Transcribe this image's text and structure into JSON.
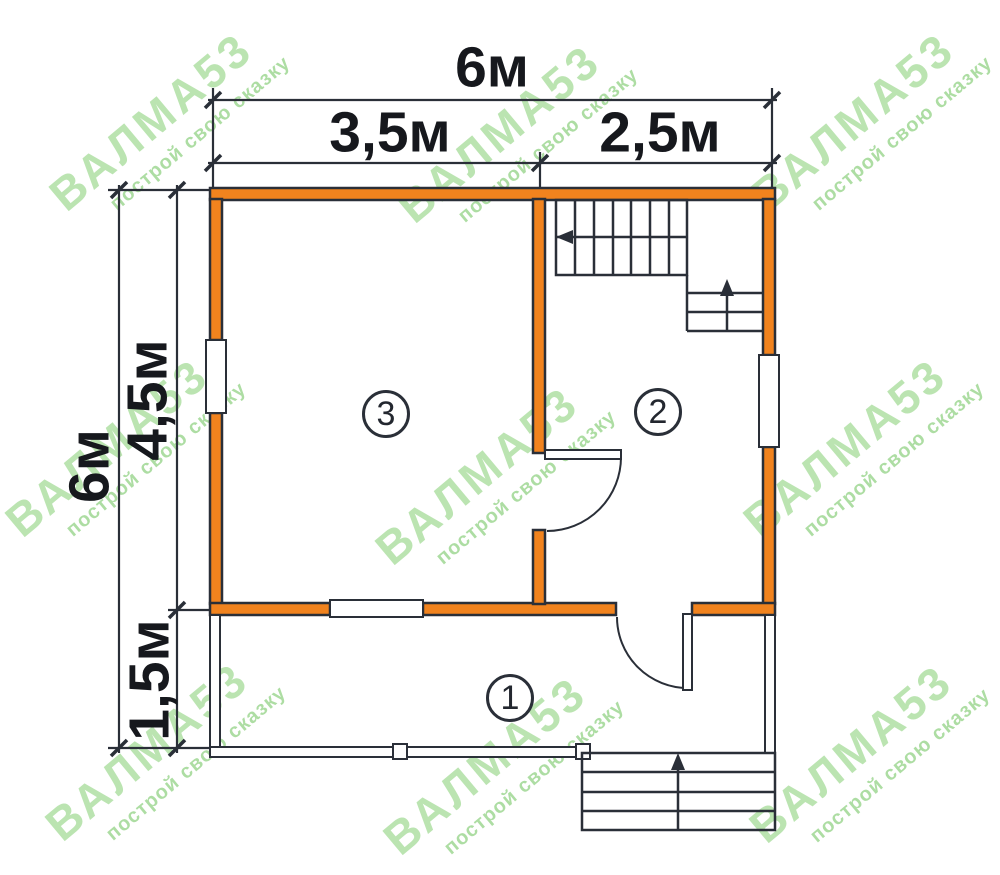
{
  "watermark": {
    "brand": "ВАЛМА53",
    "tagline": "построй свою сказку",
    "color": "#84cf73"
  },
  "dimensions": {
    "top_total": "6м",
    "top_left_section": "3,5м",
    "top_right_section": "2,5м",
    "side_total": "6м",
    "side_upper_section": "4,5м",
    "side_lower_section": "1,5м"
  },
  "rooms": [
    {
      "number": "3"
    },
    {
      "number": "2"
    },
    {
      "number": "1"
    }
  ],
  "colors": {
    "wall_fill": "#F1831E",
    "line": "#2a2f38",
    "dimension_text": "#16181d",
    "watermark_green": "#84cf73"
  }
}
